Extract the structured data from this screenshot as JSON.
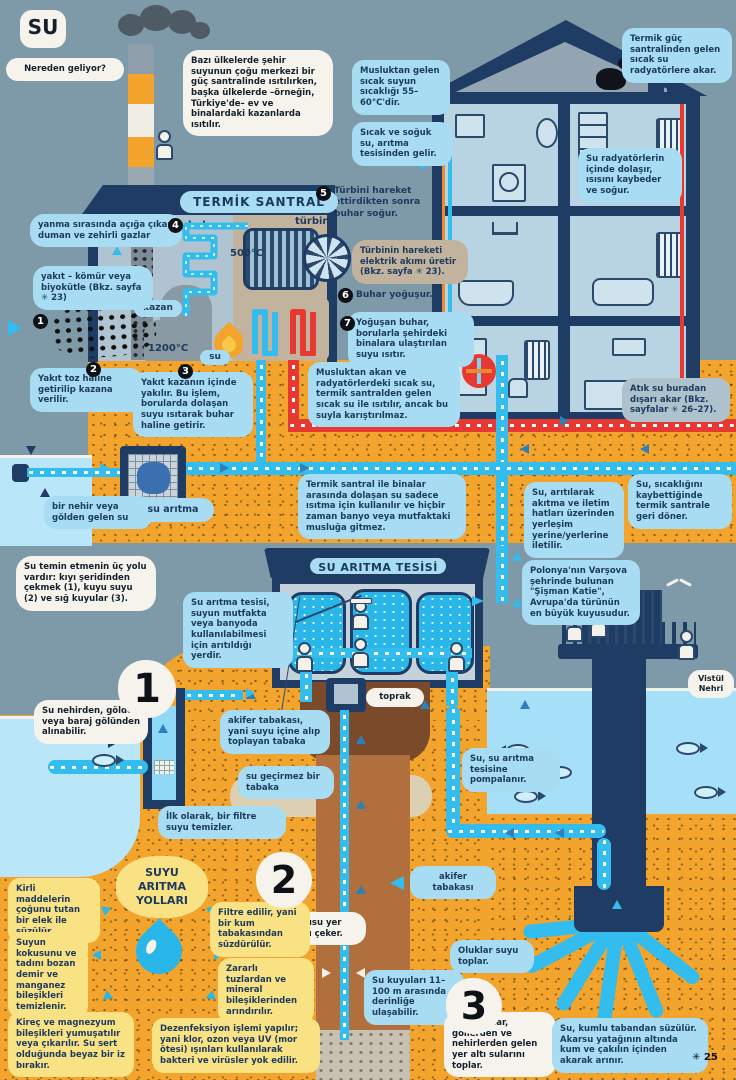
{
  "page": {
    "title": "SU",
    "page_ref": "✳ 25"
  },
  "colors": {
    "sky": "#7E99A8",
    "sand": "#F2A42D",
    "navy": "#1E3C64",
    "cyan": "#33BCEE",
    "light_water": "#B9E6F8",
    "bubble_blue": "#A7DCF2",
    "bubble_yellow": "#F9E284",
    "red": "#E73931",
    "orange_pipe": "#EE8A2D",
    "tan": "#C2B39E",
    "soil_brown": "#B06F3D"
  },
  "p1": {
    "question": "Nereden geliyor?",
    "intro": "Bazı ülkelerde şehir suyunun çoğu merkezi bir güç santralinde ısıtılırken, başka ülkelerde –örneğin, Türkiye'de– ev ve binalardaki kazanlarda ısıtılır.",
    "plant_title": "TERMİK SANTRAL",
    "smoke_label": "yanma sırasında açığa çıkan duman ve zehirli gazlar",
    "fuel_label": "yakıt – kömür veya biyokütle (Bkz. sayfa ✳ 23)",
    "steps": [
      {
        "n": "1",
        "text": ""
      },
      {
        "n": "2",
        "text": "Yakıt toz haline getirilip kazana verilir."
      },
      {
        "n": "3",
        "text": "Yakıt kazanın içinde yakılır. Bu işlem, borularda dolaşan suyu ısıtarak buhar haline getirir."
      },
      {
        "n": "4",
        "text": "buhar"
      },
      {
        "n": "5",
        "text": "Türbini hareket ettirdikten sonra buhar soğur."
      },
      {
        "n": "6",
        "text": "Buhar yoğuşur."
      },
      {
        "n": "7",
        "text": "Yoğuşan buhar, borularla şehirdeki binalara ulaştırılan suyu ısıtır."
      }
    ],
    "boiler": "kazan",
    "turbine": "türbin",
    "steam_temp": "500°C",
    "fire_temp": "1200°C",
    "water": "su",
    "turbine_note": "Türbinin hareketi elektrik akımı üretir (Bkz. sayfa ✳ 23).",
    "tap_temp": "Musluktan gelen sıcak suyun sıcaklığı 55–60°C'dir.",
    "hot_cold": "Sıcak ve soğuk su, arıtma tesisinden gelir.",
    "radiator_in": "Termik güç santralinden gelen sıcak su radyatörlere akar.",
    "radiator_cool": "Su radyatörlerin içinde dolaşır, ısısını kaybeder ve soğur.",
    "no_mix": "Musluktan akan ve radyatörlerdeki sıcak su, termik santralden gelen sıcak su ile ısıtılır, ancak bu suyla karıştırılmaz.",
    "waste_out": "Atık su buradan dışarı akar (Bkz. sayfalar ✳ 26–27).",
    "river_source": "bir nehir veya gölden gelen su",
    "treatment": "su arıtma",
    "heating_only": "Termik santral ile binalar arasında dolaşan su sadece ısıtma için kullanılır ve hiçbir zaman banyo veya mutfaktaki musluğa gitmez.",
    "distribution": "Su, arıtılarak akıtma ve iletim hatları üzerinden yerleşim yerine/yerlerine iletilir.",
    "return_cool": "Su, sıcaklığını kaybettiğinde termik santrale geri döner."
  },
  "p2": {
    "three_ways": "Su temin etmenin üç yolu vardır: kıyı şeridinden çekmek (1), kuyu suyu (2) ve sığ kuyular (3).",
    "plant_intro": "Su arıtma tesisi, suyun mutfakta veya banyoda kullanılabilmesi için arıtıldığı yerdir.",
    "plant_title": "SU ARITMA TESİSİ",
    "fat_katie": "Polonya'nın Varşova şehrinde bulunan \"Şişman Katie\", Avrupa'da türünün en büyük kuyusudur.",
    "river_name": "Vistül Nehri",
    "soil": "toprak",
    "way1": {
      "n": "1",
      "text": "Su nehirden, gölden veya baraj gölünden alınabilir."
    },
    "aquifer_def": "akifer tabakası, yani suyu içine alıp toplayan tabaka",
    "impermeable": "su geçirmez bir tabaka",
    "first_filter": "İlk olarak, bir filtre suyu temizler.",
    "way2": {
      "n": "2",
      "text": "Bir su kuyusu yer altından su çeker."
    },
    "aquifer": "akifer tabakası",
    "pumped": "Su, su arıtma tesisine pompalanır.",
    "depth": "Su kuyuları 11–100 m arasında derinliğe ulaşabilir.",
    "gutters": "Oluklar suyu toplar.",
    "way3": {
      "n": "3",
      "text": "Sığ kuyular, göllerden ve nehirlerden gelen yer altı sularını toplar."
    },
    "sand_filter": "Su, kumlu tabandan süzülür. Akarsu yatağının altında kum ve çakılın içinden akarak arınır.",
    "purify": {
      "title": "SUYU ARITMA YOLLARI",
      "items": [
        "Kirli maddelerin çoğunu tutan bir elek ile süzülür.",
        "Suyun kokusunu ve tadını bozan demir ve manganez bileşikleri temizlenir.",
        "Kireç ve magnezyum bileşikleri yumuşatılır veya çıkarılır. Su sert olduğunda beyaz bir iz bırakır.",
        "Filtre edilir, yani bir kum tabakasından süzdürülür.",
        "Zararlı tuzlardan ve mineral bileşiklerinden arındırılır.",
        "Dezenfeksiyon işlemi yapılır; yani klor, ozon veya UV (mor ötesi) ışınları kullanılarak bakteri ve virüsler yok edilir."
      ]
    }
  }
}
